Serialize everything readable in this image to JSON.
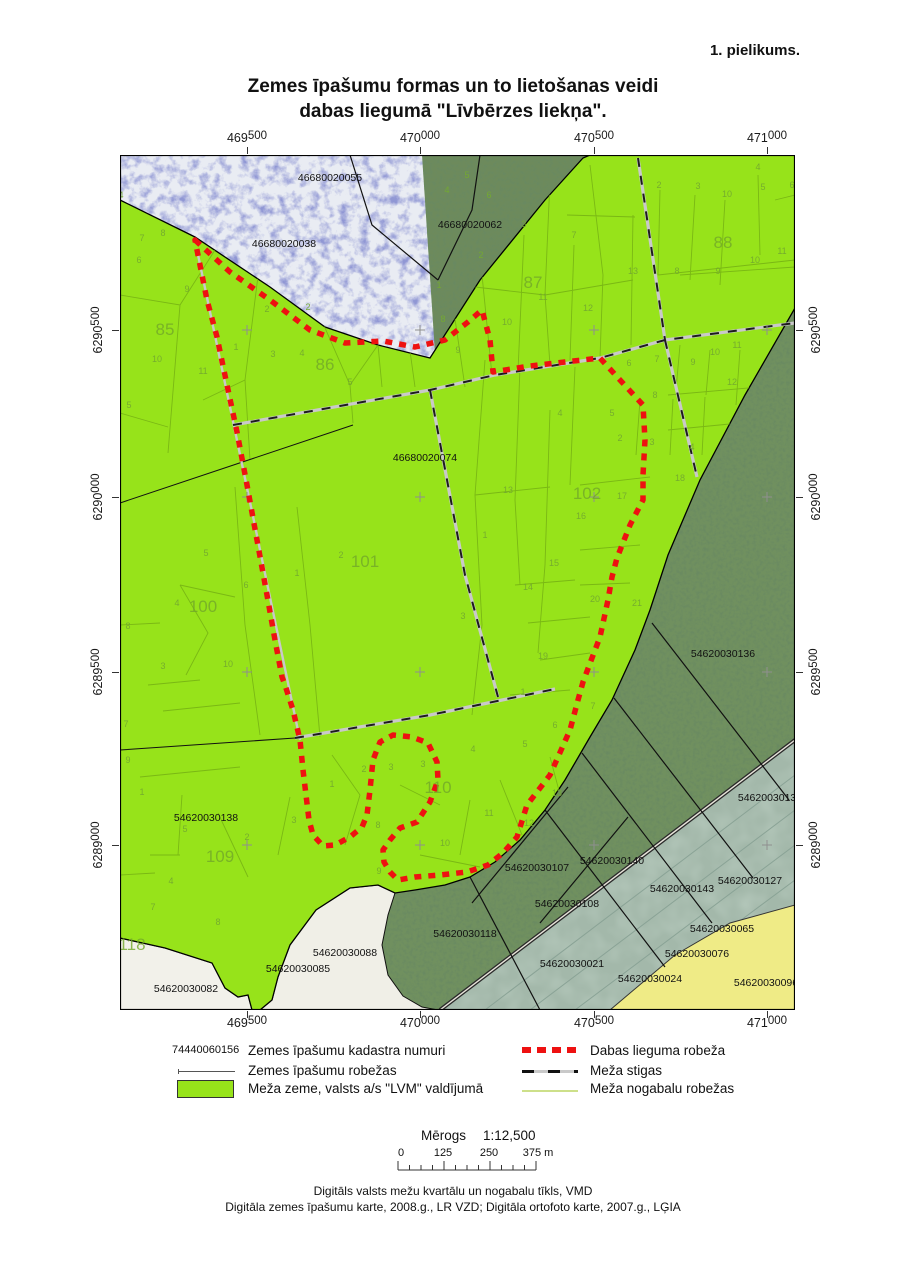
{
  "page": {
    "annex": "1. pielikums.",
    "title_line1": "Zemes īpašumu formas un to lietošanas veidi",
    "title_line2": "dabas liegumā \"Līvbērzes liekņa\".",
    "footer_line1": "Digitāls valsts mežu kvartālu un nogabalu tīkls, VMD",
    "footer_line2": "Digitāla zemes īpašumu karte, 2008.g., LR VZD; Digitāla ortofoto karte, 2007.g., LĢIA"
  },
  "legend": {
    "left": [
      {
        "type": "cadastral-sample",
        "sample": "74440060156",
        "label": "Zemes īpašumu kadastra numuri"
      },
      {
        "type": "property-line",
        "label": "Zemes īpašumu robežas"
      },
      {
        "type": "forest-fill",
        "label": "Meža zeme, valsts a/s \"LVM\" valdījumā"
      }
    ],
    "right": [
      {
        "type": "reserve-dash",
        "label": "Dabas lieguma robeža"
      },
      {
        "type": "stiga-dash",
        "label": "Meža stigas"
      },
      {
        "type": "nogabals-line",
        "label": "Meža nogabalu robežas"
      }
    ]
  },
  "scalebar": {
    "label": "Mērogs",
    "ratio": "1:12,500",
    "tick0": "0",
    "tick1": "125",
    "tick2": "250",
    "tick3": "375 m"
  },
  "colors": {
    "forest_green": "#97e31a",
    "reserve_red": "#ee1111",
    "nogabals_line": "#74b014",
    "stiga_gray": "#c9c9c9"
  },
  "map": {
    "x_ticks": [
      {
        "main": "469",
        "sup": "500",
        "pos": 127
      },
      {
        "main": "470",
        "sup": "000",
        "pos": 300
      },
      {
        "main": "470",
        "sup": "500",
        "pos": 474
      },
      {
        "main": "471",
        "sup": "000",
        "pos": 647
      }
    ],
    "y_ticks": [
      {
        "main": "6290",
        "sup": "500",
        "pos": 175
      },
      {
        "main": "6290",
        "sup": "000",
        "pos": 342
      },
      {
        "main": "6289",
        "sup": "500",
        "pos": 517
      },
      {
        "main": "6289",
        "sup": "000",
        "pos": 690
      }
    ],
    "cadastral_labels": [
      {
        "t": "46680020055",
        "x": 210,
        "y": 26
      },
      {
        "t": "46680020062",
        "x": 350,
        "y": 73
      },
      {
        "t": "46680020038",
        "x": 164,
        "y": 92
      },
      {
        "t": "46680020074",
        "x": 305,
        "y": 306
      },
      {
        "t": "54620030136",
        "x": 603,
        "y": 502
      },
      {
        "t": "54620030137",
        "x": 650,
        "y": 646
      },
      {
        "t": "54620030138",
        "x": 86,
        "y": 666
      },
      {
        "t": "54620030082",
        "x": 66,
        "y": 837
      },
      {
        "t": "54620030085",
        "x": 178,
        "y": 817
      },
      {
        "t": "54620030088",
        "x": 225,
        "y": 801
      },
      {
        "t": "54620030107",
        "x": 417,
        "y": 716
      },
      {
        "t": "54620030140",
        "x": 492,
        "y": 709
      },
      {
        "t": "54620030108",
        "x": 447,
        "y": 752
      },
      {
        "t": "54620030118",
        "x": 345,
        "y": 782
      },
      {
        "t": "54620030021",
        "x": 452,
        "y": 812
      },
      {
        "t": "54620030143",
        "x": 562,
        "y": 737
      },
      {
        "t": "54620030127",
        "x": 630,
        "y": 729
      },
      {
        "t": "54620030065",
        "x": 602,
        "y": 777
      },
      {
        "t": "54620030076",
        "x": 577,
        "y": 802
      },
      {
        "t": "54620030024",
        "x": 530,
        "y": 827
      },
      {
        "t": "54620030096",
        "x": 646,
        "y": 831
      }
    ],
    "block_labels": [
      {
        "t": "85",
        "x": 45,
        "y": 180
      },
      {
        "t": "86",
        "x": 205,
        "y": 215
      },
      {
        "t": "87",
        "x": 413,
        "y": 133
      },
      {
        "t": "88",
        "x": 603,
        "y": 93
      },
      {
        "t": "100",
        "x": 83,
        "y": 457
      },
      {
        "t": "101",
        "x": 245,
        "y": 412
      },
      {
        "t": "102",
        "x": 467,
        "y": 344
      },
      {
        "t": "109",
        "x": 100,
        "y": 707
      },
      {
        "t": "110",
        "x": 318,
        "y": 638
      },
      {
        "t": "118",
        "x": 12,
        "y": 795
      }
    ],
    "parcel_labels": [
      {
        "t": "4",
        "x": 1,
        "y": 43
      },
      {
        "t": "8",
        "x": 43,
        "y": 81
      },
      {
        "t": "7",
        "x": 22,
        "y": 86
      },
      {
        "t": "6",
        "x": 19,
        "y": 108
      },
      {
        "t": "9",
        "x": 67,
        "y": 137
      },
      {
        "t": "2",
        "x": 147,
        "y": 157
      },
      {
        "t": "1",
        "x": 116,
        "y": 195
      },
      {
        "t": "3",
        "x": 153,
        "y": 202
      },
      {
        "t": "4",
        "x": 182,
        "y": 201
      },
      {
        "t": "10",
        "x": 37,
        "y": 207
      },
      {
        "t": "11",
        "x": 83,
        "y": 219
      },
      {
        "t": "5",
        "x": 9,
        "y": 253
      },
      {
        "t": "5",
        "x": 230,
        "y": 230
      },
      {
        "t": "2",
        "x": 188,
        "y": 155
      },
      {
        "t": "4",
        "x": 327,
        "y": 38
      },
      {
        "t": "5",
        "x": 347,
        "y": 23
      },
      {
        "t": "6",
        "x": 369,
        "y": 43
      },
      {
        "t": "3",
        "x": 404,
        "y": 72
      },
      {
        "t": "7",
        "x": 454,
        "y": 83
      },
      {
        "t": "2",
        "x": 361,
        "y": 103
      },
      {
        "t": "1",
        "x": 319,
        "y": 133
      },
      {
        "t": "8",
        "x": 323,
        "y": 167
      },
      {
        "t": "9",
        "x": 338,
        "y": 198
      },
      {
        "t": "10",
        "x": 387,
        "y": 170
      },
      {
        "t": "11",
        "x": 423,
        "y": 145
      },
      {
        "t": "12",
        "x": 468,
        "y": 156
      },
      {
        "t": "13",
        "x": 513,
        "y": 119
      },
      {
        "t": "2",
        "x": 539,
        "y": 33
      },
      {
        "t": "3",
        "x": 578,
        "y": 34
      },
      {
        "t": "10",
        "x": 607,
        "y": 42
      },
      {
        "t": "4",
        "x": 638,
        "y": 15
      },
      {
        "t": "5",
        "x": 643,
        "y": 35
      },
      {
        "t": "6",
        "x": 672,
        "y": 33
      },
      {
        "t": "8",
        "x": 557,
        "y": 119
      },
      {
        "t": "9",
        "x": 598,
        "y": 119
      },
      {
        "t": "10",
        "x": 635,
        "y": 108
      },
      {
        "t": "11",
        "x": 662,
        "y": 99
      },
      {
        "t": "10",
        "x": 595,
        "y": 200
      },
      {
        "t": "11",
        "x": 617,
        "y": 193
      },
      {
        "t": "9",
        "x": 573,
        "y": 210
      },
      {
        "t": "7",
        "x": 537,
        "y": 207
      },
      {
        "t": "6",
        "x": 509,
        "y": 211
      },
      {
        "t": "12",
        "x": 612,
        "y": 230
      },
      {
        "t": "8",
        "x": 535,
        "y": 243
      },
      {
        "t": "2",
        "x": 500,
        "y": 286
      },
      {
        "t": "3",
        "x": 532,
        "y": 290
      },
      {
        "t": "4",
        "x": 572,
        "y": 295
      },
      {
        "t": "13",
        "x": 388,
        "y": 338
      },
      {
        "t": "16",
        "x": 461,
        "y": 364
      },
      {
        "t": "17",
        "x": 502,
        "y": 344
      },
      {
        "t": "18",
        "x": 560,
        "y": 326
      },
      {
        "t": "1",
        "x": 365,
        "y": 383
      },
      {
        "t": "15",
        "x": 434,
        "y": 411
      },
      {
        "t": "14",
        "x": 408,
        "y": 435
      },
      {
        "t": "20",
        "x": 475,
        "y": 447
      },
      {
        "t": "21",
        "x": 517,
        "y": 451
      },
      {
        "t": "19",
        "x": 423,
        "y": 504
      },
      {
        "t": "5",
        "x": 492,
        "y": 261
      },
      {
        "t": "4",
        "x": 440,
        "y": 261
      },
      {
        "t": "2",
        "x": 221,
        "y": 403
      },
      {
        "t": "1",
        "x": 177,
        "y": 421
      },
      {
        "t": "3",
        "x": 343,
        "y": 464
      },
      {
        "t": "5",
        "x": 86,
        "y": 401
      },
      {
        "t": "6",
        "x": 126,
        "y": 433
      },
      {
        "t": "4",
        "x": 57,
        "y": 451
      },
      {
        "t": "8",
        "x": 8,
        "y": 474
      },
      {
        "t": "3",
        "x": 43,
        "y": 514
      },
      {
        "t": "10",
        "x": 108,
        "y": 512
      },
      {
        "t": "1",
        "x": 22,
        "y": 640
      },
      {
        "t": "5",
        "x": 65,
        "y": 677
      },
      {
        "t": "2",
        "x": 127,
        "y": 685
      },
      {
        "t": "3",
        "x": 174,
        "y": 668
      },
      {
        "t": "4",
        "x": 51,
        "y": 729
      },
      {
        "t": "7",
        "x": 33,
        "y": 755
      },
      {
        "t": "8",
        "x": 98,
        "y": 770
      },
      {
        "t": "1",
        "x": 212,
        "y": 632
      },
      {
        "t": "2",
        "x": 244,
        "y": 617
      },
      {
        "t": "3",
        "x": 271,
        "y": 615
      },
      {
        "t": "3",
        "x": 303,
        "y": 612
      },
      {
        "t": "4",
        "x": 353,
        "y": 597
      },
      {
        "t": "5",
        "x": 405,
        "y": 592
      },
      {
        "t": "6",
        "x": 435,
        "y": 573
      },
      {
        "t": "7",
        "x": 473,
        "y": 554
      },
      {
        "t": "8",
        "x": 258,
        "y": 673
      },
      {
        "t": "9",
        "x": 259,
        "y": 719
      },
      {
        "t": "10",
        "x": 325,
        "y": 691
      },
      {
        "t": "11",
        "x": 369,
        "y": 661
      },
      {
        "t": "12",
        "x": 409,
        "y": 671
      },
      {
        "t": "13",
        "x": 437,
        "y": 641
      },
      {
        "t": "1",
        "x": 403,
        "y": 540
      },
      {
        "t": "9",
        "x": 8,
        "y": 608
      },
      {
        "t": "7",
        "x": 6,
        "y": 572
      }
    ]
  }
}
